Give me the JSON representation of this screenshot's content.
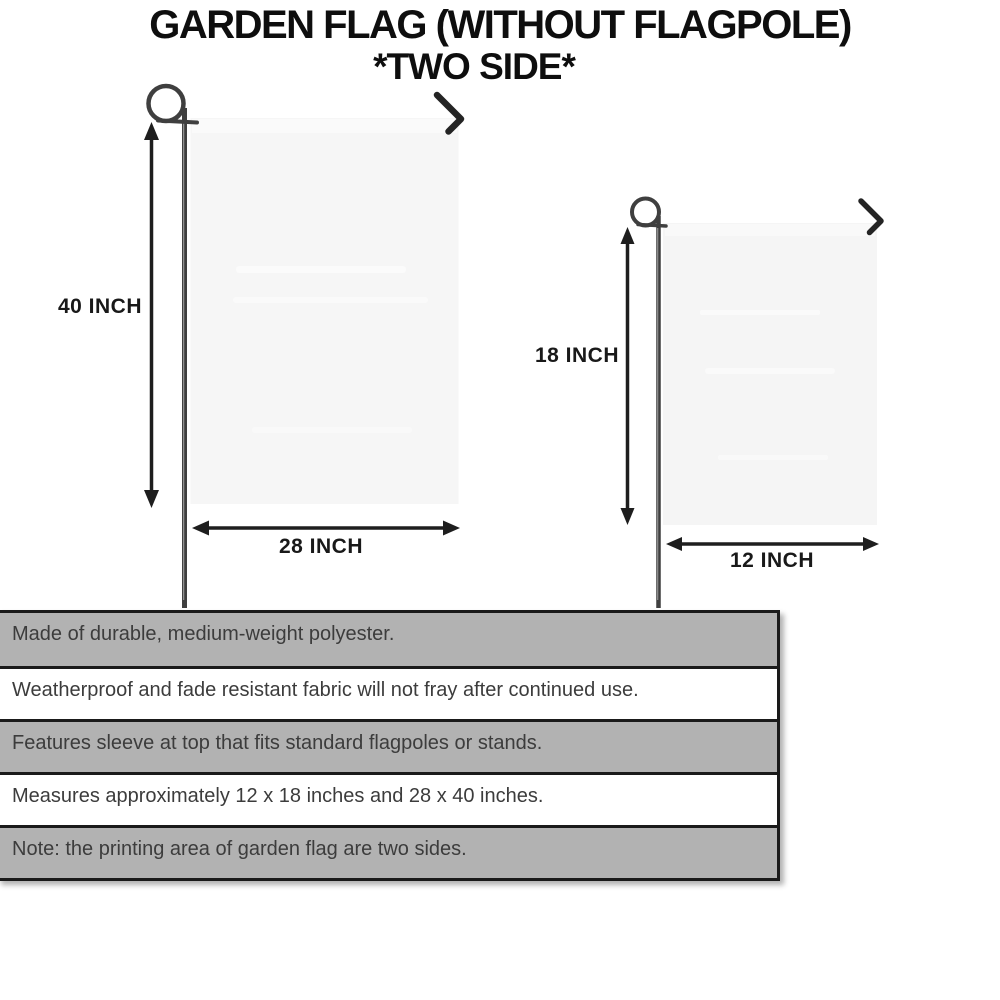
{
  "title": {
    "line1": "GARDEN FLAG (WITHOUT FLAGPOLE)",
    "line2": "*TWO SIDE*"
  },
  "flags": {
    "large": {
      "height_label": "40 INCH",
      "width_label": "28 INCH"
    },
    "small": {
      "height_label": "18 INCH",
      "width_label": "12 INCH"
    }
  },
  "features": {
    "rows": [
      {
        "text": "Made of durable, medium-weight polyester."
      },
      {
        "text": "Weatherproof and fade resistant fabric will not fray after continued use."
      },
      {
        "text": "Features sleeve at top that fits standard flagpoles or stands."
      },
      {
        "text": "Measures approximately 12 x 18 inches and 28 x 40 inches."
      },
      {
        "text": "Note: the printing area of garden flag are two sides."
      }
    ]
  },
  "diagram": {
    "parts": [
      "flagpole-loop",
      "flagpole",
      "flag-panel",
      "clip-hook",
      "height-arrow",
      "width-arrow"
    ]
  },
  "colors": {
    "background": "#ffffff",
    "ink": "#191919",
    "arrow": "#1e1e1e",
    "pole": "#3f3f3f",
    "flag_fill": "#f6f6f6",
    "row_shaded": "#b2b2b2",
    "row_plain": "#ffffff",
    "table_border": "#1a1a1a"
  }
}
